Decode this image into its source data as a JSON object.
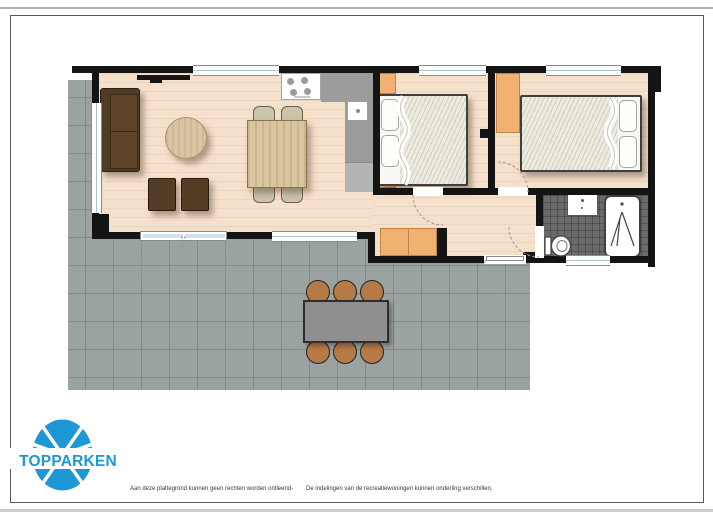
{
  "page": {
    "title": "TopParken recreatiewoning plattegrond",
    "logo": {
      "text": "TOPPARKEN",
      "color": "#1e97d5"
    },
    "footer": {
      "disclaimer_left": "Aan deze plattegrond kunnen geen rechten worden ontleend",
      "separator": "-",
      "disclaimer_right": "De indelingen van de recreatiewoningen kunnen onderling verschillen."
    }
  },
  "palette": {
    "wall": "#141414",
    "room_floor": "#f5e0cc",
    "terrace_tile": "#9aa3a2",
    "bathroom_floor": "#6a6a6a",
    "cabinet_orange": "#f0b173",
    "sofa_brown": "#553d25",
    "wood_table": "#d9c59f",
    "counter_gray": "#9c9c9c",
    "outdoor_table_gray": "#8f8f8f",
    "outdoor_chair_tan": "#b57a45",
    "door_glass": "#cfe4ea",
    "logo_blue": "#1e97d5"
  },
  "floorplan": {
    "rooms": [
      {
        "name": "living-room",
        "furniture": [
          "sofa",
          "coffee-table",
          "armchair",
          "armchair",
          "dining-table",
          "dining-chair-x4",
          "tv"
        ]
      },
      {
        "name": "kitchen",
        "furniture": [
          "stove",
          "counter",
          "sink"
        ]
      },
      {
        "name": "bedroom-1",
        "furniture": [
          "double-bed",
          "wardrobe",
          "wardrobe"
        ]
      },
      {
        "name": "bedroom-2",
        "furniture": [
          "double-bed",
          "wardrobe"
        ]
      },
      {
        "name": "hallway",
        "furniture": [
          "cabinet",
          "entrance-door"
        ]
      },
      {
        "name": "bathroom",
        "furniture": [
          "washbasin",
          "shower",
          "toilet"
        ]
      },
      {
        "name": "terrace",
        "furniture": [
          "outdoor-table",
          "outdoor-chair-x6",
          "french-doors"
        ]
      }
    ]
  }
}
